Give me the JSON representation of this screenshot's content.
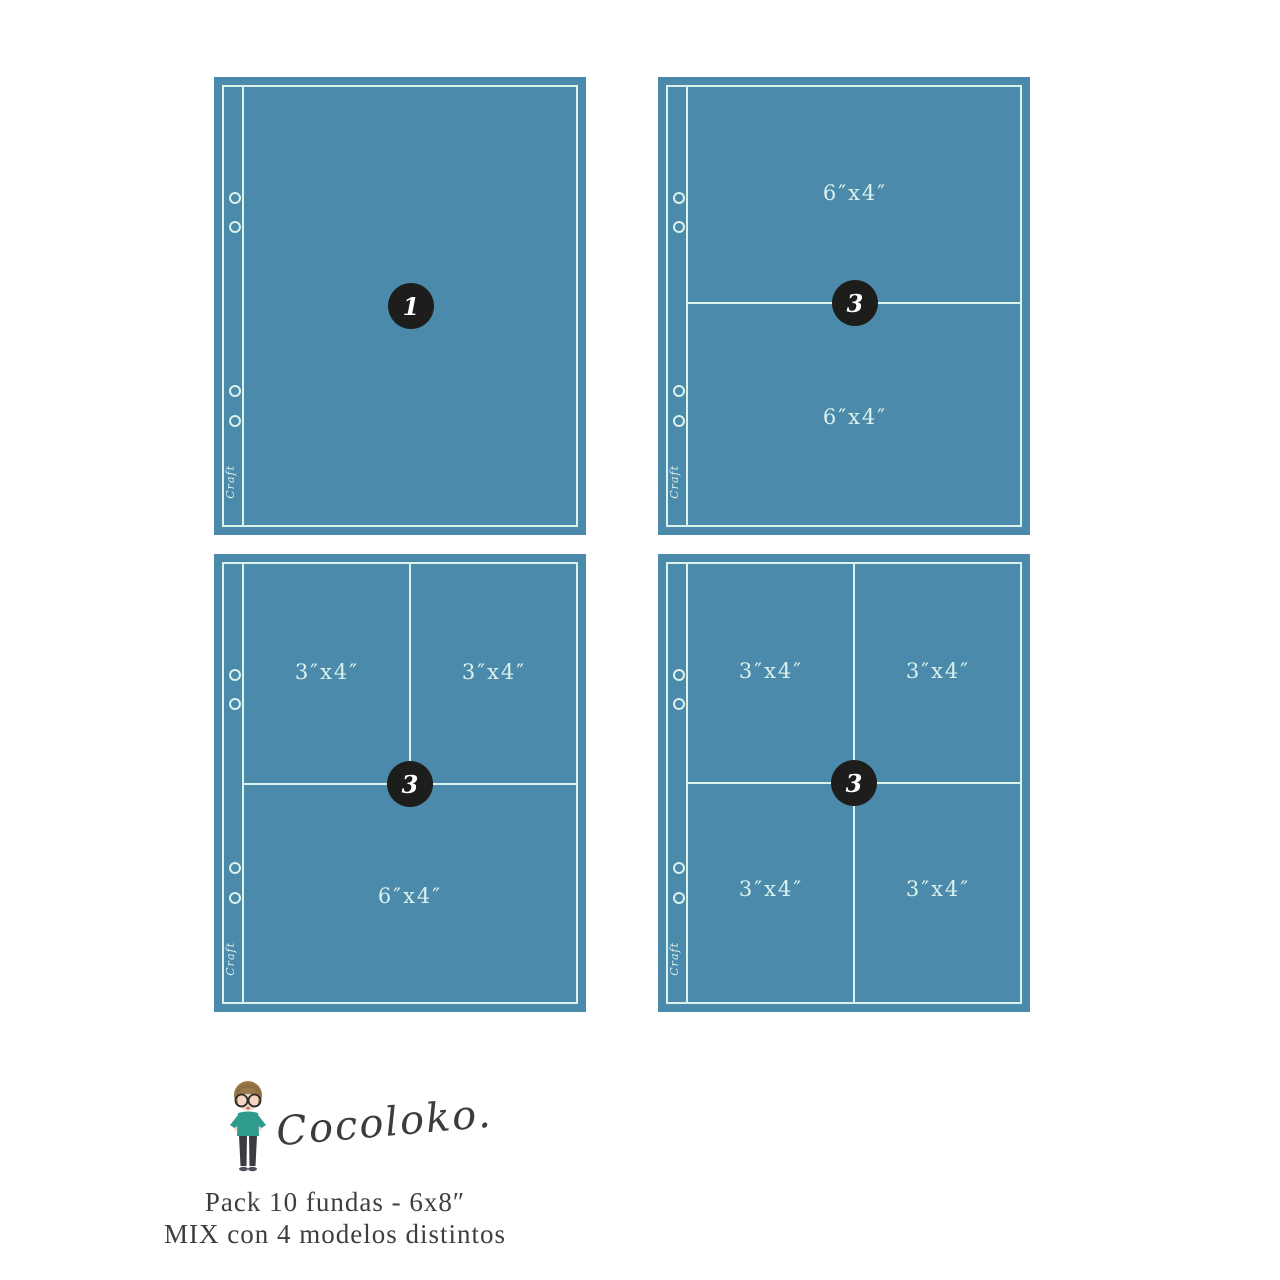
{
  "colors": {
    "page_fill": "#4b8aab",
    "line": "#daf1ec",
    "badge_bg": "#1d1d1b",
    "badge_text": "#ffffff",
    "footer_text": "#3e3e3e",
    "mascot_hair": "#9a7a4c",
    "mascot_skin": "#f4d6c0",
    "mascot_shirt": "#2f9b8e",
    "mascot_pants": "#3b3b42"
  },
  "strip_signature": "Craft",
  "pages": [
    {
      "model": "full-page-pocket",
      "quantity_badge": "1",
      "pockets": []
    },
    {
      "model": "two-horizontal-6x4-pockets",
      "quantity_badge": "3",
      "pockets": [
        {
          "label": "6″x4″"
        },
        {
          "label": "6″x4″"
        }
      ]
    },
    {
      "model": "two-3x4-top-one-6x4-bottom",
      "quantity_badge": "3",
      "pockets": [
        {
          "label": "3″x4″"
        },
        {
          "label": "3″x4″"
        },
        {
          "label": "6″x4″"
        }
      ]
    },
    {
      "model": "four-3x4-pockets",
      "quantity_badge": "3",
      "pockets": [
        {
          "label": "3″x4″"
        },
        {
          "label": "3″x4″"
        },
        {
          "label": "3″x4″"
        },
        {
          "label": "3″x4″"
        }
      ]
    }
  ],
  "footer": {
    "brand": "Cocoloko.",
    "line1": "Pack 10 fundas - 6x8″",
    "line2": "MIX con 4 modelos distintos"
  }
}
